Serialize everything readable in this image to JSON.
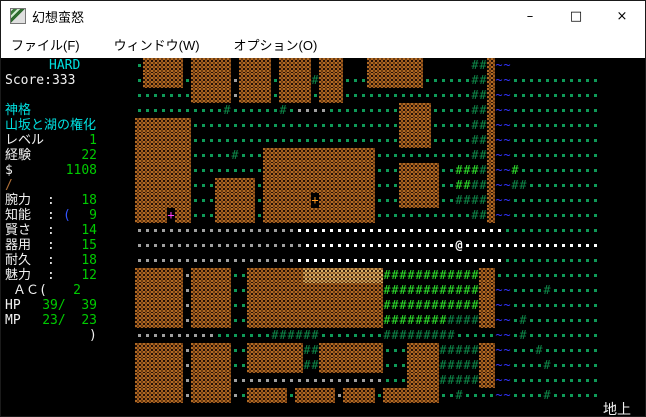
{
  "window": {
    "title": "幻想蛮怒",
    "controls": {
      "minimize": "–",
      "maximize": "□",
      "close": "×"
    }
  },
  "menu": {
    "items": [
      {
        "label": "ファイル(F)"
      },
      {
        "label": "ウィンドウ(W)"
      },
      {
        "label": "オプション(O)"
      }
    ]
  },
  "sidebar": {
    "difficulty": "HARD",
    "score": "Score:333",
    "class_name": "神格",
    "char_title": "山坂と湖の権化",
    "level": {
      "label": "レベル",
      "value": "1"
    },
    "exp": {
      "label": "経験",
      "value": "22"
    },
    "gold": {
      "label": "$",
      "value": "1108"
    },
    "equipment": {
      "weapon_symbol": "/",
      "armor_symbol": "("
    },
    "abilities": [
      {
        "label": "腕力",
        "value": "18"
      },
      {
        "label": "知能",
        "value": "9"
      },
      {
        "label": "賢さ",
        "value": "14"
      },
      {
        "label": "器用",
        "value": "15"
      },
      {
        "label": "耐久",
        "value": "18"
      },
      {
        "label": "魅力",
        "value": "12"
      }
    ],
    "ac": {
      "label": "ＡＣ(",
      "value": "2",
      "close": ")"
    },
    "hp": {
      "label": "HP",
      "value": "39/  39"
    },
    "mp": {
      "label": "MP",
      "value": "23/  23"
    }
  },
  "status_bar": {
    "location": "地上"
  },
  "colors": {
    "sidebar_cyan": "#00e0e0",
    "sidebar_green": "#00cc00",
    "sidebar_white": "#f2f2f2",
    "weapon_umber": "#b07038",
    "armor_blue": "#3355ff"
  },
  "map": {
    "legend": {
      "#": {
        "name": "map-cell-wall",
        "type": "wall"
      },
      "%": {
        "name": "map-cell-wall-light",
        "type": "tan"
      },
      ".": {
        "name": "map-cell-floor-green",
        "type": "dot",
        "color": "#0e9a58"
      },
      ",": {
        "name": "map-cell-floor-gray",
        "type": "dot",
        "color": "#a0a0a0"
      },
      "o": {
        "name": "map-cell-floor-lit",
        "type": "dot",
        "color": "#ffffff"
      },
      "~": {
        "name": "map-cell-water",
        "type": "glyph",
        "glyph": "~",
        "color": "#3333ff"
      },
      "f": {
        "name": "map-cell-tree",
        "type": "glyph",
        "glyph": "#",
        "color": "#0e8a4a"
      },
      "F": {
        "name": "map-cell-tree-bright",
        "type": "glyph",
        "glyph": "#",
        "color": "#2ee52e"
      },
      "@": {
        "name": "player-symbol",
        "type": "glyph",
        "glyph": "@",
        "color": "#ffffff"
      },
      "+": {
        "name": "door-magenta",
        "type": "glyph",
        "glyph": "+",
        "color": "#ff44ff"
      },
      "D": {
        "name": "door-orange",
        "type": "glyph",
        "glyph": "+",
        "color": "#ff9922"
      }
    },
    "rows": [
      ".##### ##### #### #### ###   #######      ff#~~                ",
      ".#####.#####,####.####f###...#######......ff#~~...........     ",
      ".......#####,####.####.###................ff#~~...........     ",
      "...........f......f.,,,,.........####.....ff#~~...........     ",
      "#######..........................####.....ff#~~...........     ",
      "#######..........................####.....ff#~~...........     ",
      "#######.....f...##############............ff#~~...........     ",
      "#######.........##############...#####..FFFf#~~F..........     ",
      "#######...#####.##############...#####..FFff#~~ff.........     ",
      "#######...#####.######D#######...#####..ffff#~~...........     ",
      "####+##...#####.##############............ff#~~...........     ",
      ",,,,,,,,,,,,,,,,,,,,oooooooooooooooooooooooooo............     ",
      ",,,,,,,,,,,,,,,,,,,,,ooooooooooooooooooo@ooooooooooooooooo     ",
      ",,,,,,,,,,,,,,,,,,,,oooooooooooooooooooooooooo............     ",
      "######,#####..#######%%%%%%%%%%FFFFFFFFFFFF##.............     ",
      "######,#####..#################FFFFFFFFFFFF##~~....f......     ",
      "######,#####..#################FFFFFFFFFFFF##~~...........     ",
      "######,#####..#################FFFFFFFFffff##~~.f.........     ",
      ",,,,,,,,,,.......ffffff........fffffffff.....~~.f.........     ",
      "######,#####..#######ff########...####fffff##~~...f.......     ",
      "######,#####..#######ff########...####fffff##~~....f......     ",
      "######,#####,,,,,,,,,,,,,,,,,,,...####fffff##~~...........     ",
      "######,#####,.#####.#####,####.#######..f....~~....f......     "
    ]
  }
}
